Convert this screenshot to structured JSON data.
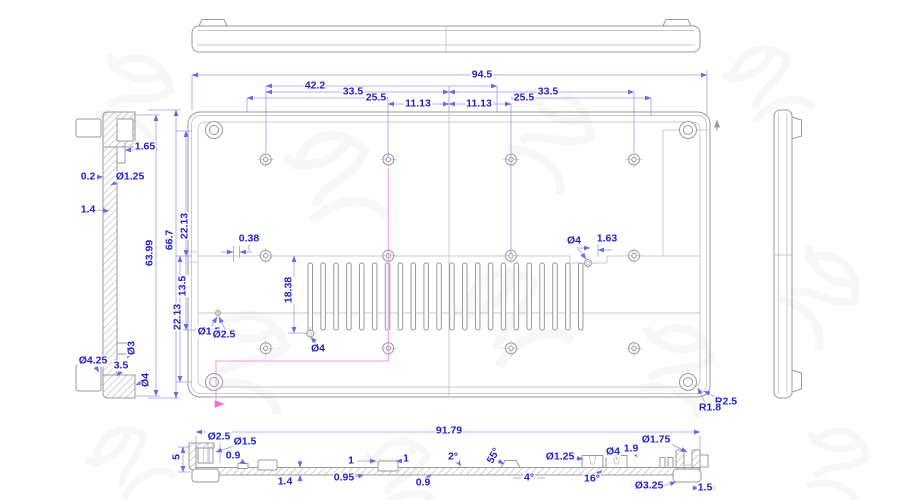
{
  "drawing_type": "engineering-cad-drawing",
  "colors": {
    "dimension_text": "#1e1ed2",
    "dimension_lines": "#9b9bec",
    "geometry_lines": "#999999",
    "section_path": "#f79be4",
    "background": "#ffffff"
  },
  "views": {
    "top_edge_view": {
      "dims": []
    },
    "right_side_view": {
      "dims": []
    },
    "left_section_view": {
      "dims": [
        {
          "text": "1.65",
          "x": 145,
          "y": 147
        },
        {
          "text": "0.2",
          "x": 88,
          "y": 177
        },
        {
          "text": "Ø1.25",
          "x": 130,
          "y": 177
        },
        {
          "text": "1.4",
          "x": 88,
          "y": 210
        },
        {
          "text": "63.99",
          "x": 150,
          "y": 253,
          "rot": -90
        },
        {
          "text": "66.7",
          "x": 170,
          "y": 240,
          "rot": -90
        },
        {
          "text": "22.13",
          "x": 185,
          "y": 226,
          "rot": -90
        },
        {
          "text": "13.5",
          "x": 183,
          "y": 286,
          "rot": -90
        },
        {
          "text": "22.13",
          "x": 178,
          "y": 317,
          "rot": -90
        },
        {
          "text": "Ø3",
          "x": 132,
          "y": 348,
          "rot": -90
        },
        {
          "text": "Ø4.25",
          "x": 93,
          "y": 361
        },
        {
          "text": "3.5",
          "x": 121,
          "y": 366
        },
        {
          "text": "Ø4",
          "x": 146,
          "y": 380,
          "rot": -90
        }
      ]
    },
    "main_bottom_view": {
      "dims": [
        {
          "text": "94.5",
          "x": 482,
          "y": 75
        },
        {
          "text": "42.2",
          "x": 315,
          "y": 86
        },
        {
          "text": "33.5",
          "x": 353,
          "y": 92
        },
        {
          "text": "25.5",
          "x": 376,
          "y": 98
        },
        {
          "text": "11.13",
          "x": 418,
          "y": 104
        },
        {
          "text": "11.13",
          "x": 479,
          "y": 104
        },
        {
          "text": "25.5",
          "x": 524,
          "y": 98
        },
        {
          "text": "33.5",
          "x": 548,
          "y": 92
        },
        {
          "text": "0.38",
          "x": 249,
          "y": 239
        },
        {
          "text": "18.38",
          "x": 289,
          "y": 290,
          "rot": -90
        },
        {
          "text": "Ø4",
          "x": 318,
          "y": 349
        },
        {
          "text": "Ø1.5",
          "x": 209,
          "y": 332
        },
        {
          "text": "Ø2.5",
          "x": 224,
          "y": 335
        },
        {
          "text": "Ø4",
          "x": 574,
          "y": 241
        },
        {
          "text": "1.63",
          "x": 607,
          "y": 239
        },
        {
          "text": "R2.5",
          "x": 726,
          "y": 402
        },
        {
          "text": "R1.8",
          "x": 710,
          "y": 408
        }
      ]
    },
    "bottom_section_view": {
      "dims": [
        {
          "text": "91.79",
          "x": 449,
          "y": 431
        },
        {
          "text": "Ø2.5",
          "x": 219,
          "y": 437
        },
        {
          "text": "Ø1.5",
          "x": 245,
          "y": 442
        },
        {
          "text": "0.9",
          "x": 233,
          "y": 456
        },
        {
          "text": "5",
          "x": 177,
          "y": 457,
          "rot": -90
        },
        {
          "text": "1.4",
          "x": 285,
          "y": 482
        },
        {
          "text": "0.95",
          "x": 344,
          "y": 478
        },
        {
          "text": "1",
          "x": 351,
          "y": 461
        },
        {
          "text": "1",
          "x": 406,
          "y": 459
        },
        {
          "text": "2°",
          "x": 453,
          "y": 457
        },
        {
          "text": "0.9",
          "x": 423,
          "y": 483
        },
        {
          "text": "55°",
          "x": 494,
          "y": 456,
          "rot": -62
        },
        {
          "text": "4°",
          "x": 529,
          "y": 478
        },
        {
          "text": "Ø1.25",
          "x": 560,
          "y": 457
        },
        {
          "text": "16°",
          "x": 592,
          "y": 479
        },
        {
          "text": "Ø4",
          "x": 613,
          "y": 452
        },
        {
          "text": "1.9",
          "x": 631,
          "y": 449
        },
        {
          "text": "Ø1.75",
          "x": 656,
          "y": 440
        },
        {
          "text": "Ø3.25",
          "x": 649,
          "y": 486
        },
        {
          "text": "1.5",
          "x": 705,
          "y": 488
        }
      ]
    }
  }
}
